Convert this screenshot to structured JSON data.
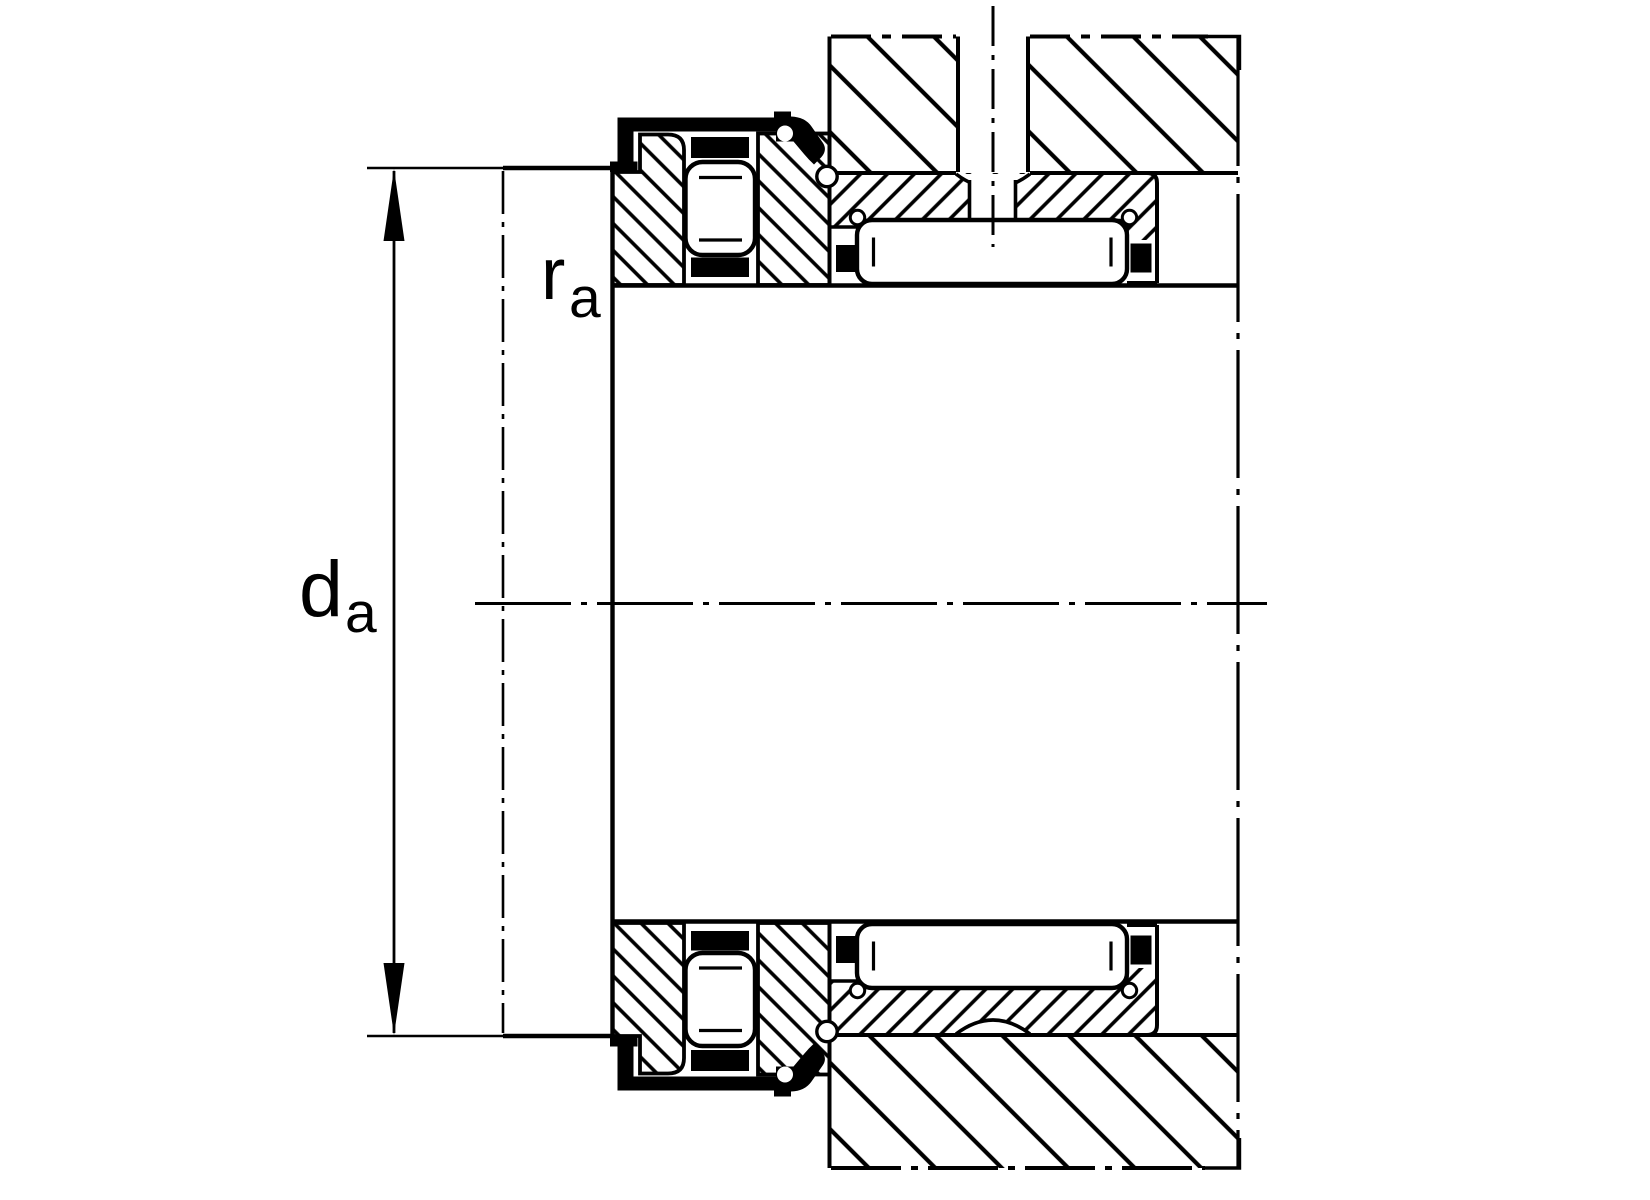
{
  "figure": {
    "kind": "engineering-cross-section",
    "subject": "needle-roller-axial-roller-bearing-mounting-drawing",
    "background_color": "#ffffff",
    "line_color": "#000000"
  },
  "labels": {
    "da": {
      "symbol": "d",
      "subscript": "a"
    },
    "ra": {
      "symbol": "r",
      "subscript": "a"
    }
  }
}
